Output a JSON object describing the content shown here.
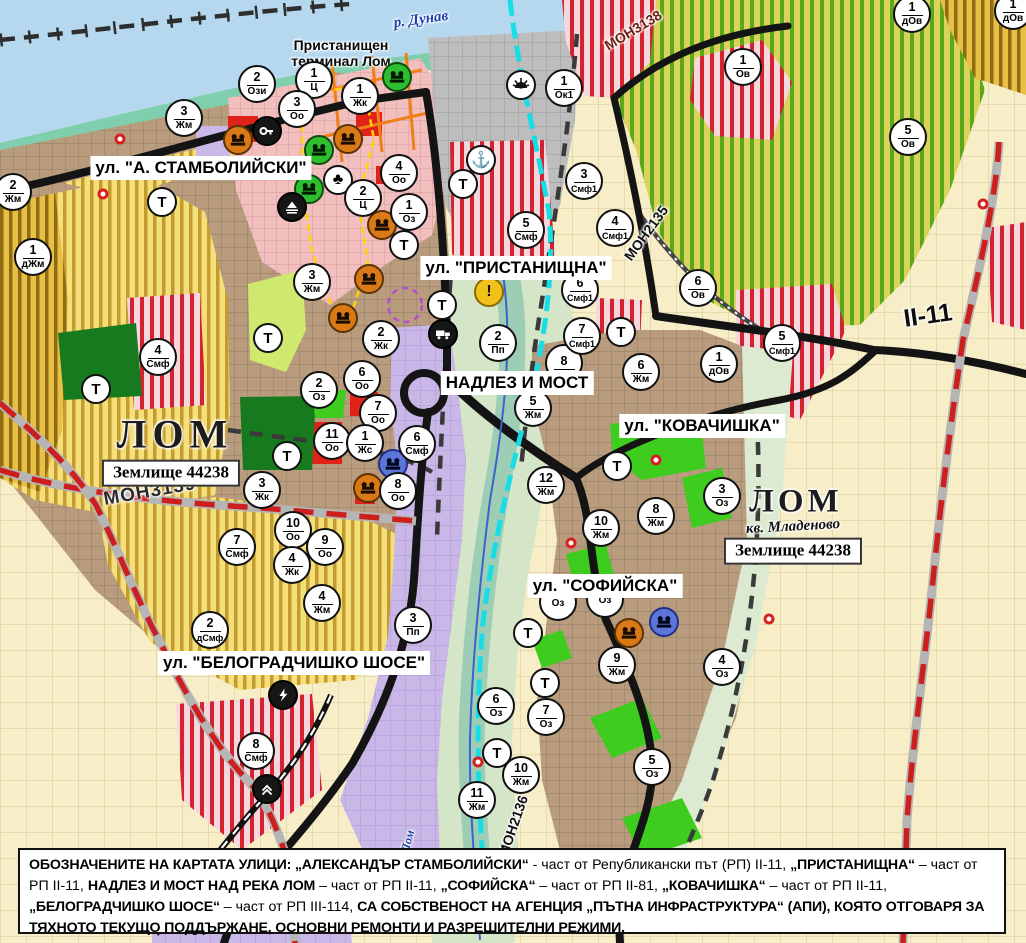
{
  "map_title": "Устройствен план на гр. Лом - обозначени улици на АПИ",
  "colors": {
    "water": "#b5d8ef",
    "shore": "#7fcfae",
    "urban_brown": "#b99c7e",
    "pink_center": "#f3bebe",
    "yellow_zone": "#f5df7a",
    "yellow_stripe": "#c49b2e",
    "mustard_zone": "#e9bf45",
    "vineyard_base": "#d8d35b",
    "vineyard_stripe": "#5ca81c",
    "smf_base": "#f6d7de",
    "smf_stripe": "#d4232e",
    "red_zone": "#e02218",
    "green_zone": "#3ecc1e",
    "dark_green": "#177a1e",
    "violet_zone": "#c9b7e8",
    "gray_port": "#bdbdbd",
    "cream": "#f7eec8",
    "road_black": "#141414",
    "road_red_dash": "#ce1f1f",
    "cyan_channel": "#17dde7",
    "river_blue": "#3b63c8"
  },
  "street_labels": [
    {
      "text": "ул. \"А. СТАМБОЛИЙСКИ\"",
      "x": 201,
      "y": 168
    },
    {
      "text": "ул. \"ПРИСТАНИЩНА\"",
      "x": 516,
      "y": 268
    },
    {
      "text": "НАДЛЕЗ И МОСТ",
      "x": 517,
      "y": 383
    },
    {
      "text": "ул. \"КОВАЧИШКА\"",
      "x": 702,
      "y": 426
    },
    {
      "text": "ул. \"СОФИЙСКА\"",
      "x": 605,
      "y": 586
    },
    {
      "text": "ул. \"БЕЛОГРАДЧИШКО ШОСЕ\"",
      "x": 294,
      "y": 663
    }
  ],
  "place_labels": [
    {
      "cls": "danube",
      "text": "р. Дунав",
      "x": 421,
      "y": 20,
      "rot": -8
    },
    {
      "cls": "terminal",
      "text": "Пристанищен\nтерминал Лом",
      "x": 341,
      "y": 53,
      "rot": 0
    },
    {
      "cls": "lomcity",
      "text": "ЛОМ",
      "x": 175,
      "y": 434,
      "rot": 0
    },
    {
      "cls": "zembox",
      "text": "Землище\n44238",
      "x": 171,
      "y": 473,
      "rot": 0
    },
    {
      "cls": "lomcity2",
      "text": "ЛОМ",
      "x": 796,
      "y": 502,
      "rot": 0
    },
    {
      "cls": "kvartal",
      "text": "кв. Младеново",
      "x": 793,
      "y": 527,
      "rot": -3
    },
    {
      "cls": "zembox",
      "text": "Землище\n44238",
      "x": 793,
      "y": 551,
      "rot": 0
    },
    {
      "cls": "riverlom",
      "text": "Лом",
      "x": 408,
      "y": 841,
      "rot": -75
    }
  ],
  "road_codes": [
    {
      "cls": "code-lg",
      "text": "МОН3139",
      "x": 150,
      "y": 492,
      "rot": -10
    },
    {
      "cls": "code-red",
      "text": "МОН3138",
      "x": 633,
      "y": 30,
      "rot": -31
    },
    {
      "cls": "code-sm",
      "text": "МОН2135",
      "x": 646,
      "y": 233,
      "rot": -54
    },
    {
      "cls": "code-sm",
      "text": "МОН2136",
      "x": 513,
      "y": 826,
      "rot": -71
    },
    {
      "cls": "code-xl",
      "text": "II-11",
      "x": 928,
      "y": 316,
      "rot": -8
    }
  ],
  "zone_markers": [
    {
      "num": "2",
      "code": "Ози",
      "x": 257,
      "y": 84
    },
    {
      "num": "1",
      "code": "Ц",
      "x": 314,
      "y": 80
    },
    {
      "num": "3",
      "code": "Оо",
      "x": 297,
      "y": 109
    },
    {
      "num": "1",
      "code": "Жк",
      "x": 360,
      "y": 96
    },
    {
      "num": "1",
      "code": "Ок1",
      "x": 564,
      "y": 88
    },
    {
      "num": "3",
      "code": "Жм",
      "x": 184,
      "y": 118
    },
    {
      "num": "2",
      "code": "Жм",
      "x": 13,
      "y": 192
    },
    {
      "num": "1",
      "code": "дЖм",
      "x": 33,
      "y": 257
    },
    {
      "num": "4",
      "code": "Оо",
      "x": 399,
      "y": 173
    },
    {
      "num": "2",
      "code": "Ц",
      "x": 363,
      "y": 198
    },
    {
      "num": "1",
      "code": "Оз",
      "x": 409,
      "y": 212
    },
    {
      "num": "3",
      "code": "Смф1",
      "x": 584,
      "y": 181
    },
    {
      "num": "5",
      "code": "Смф",
      "x": 526,
      "y": 230
    },
    {
      "num": "4",
      "code": "Смф1",
      "x": 615,
      "y": 228
    },
    {
      "num": "6",
      "code": "Смф1",
      "x": 580,
      "y": 290
    },
    {
      "num": "1",
      "code": "Ов",
      "x": 743,
      "y": 67
    },
    {
      "num": "5",
      "code": "Ов",
      "x": 908,
      "y": 137
    },
    {
      "num": "1",
      "code": "дОв",
      "x": 912,
      "y": 14
    },
    {
      "num": "1",
      "code": "дОв",
      "x": 1013,
      "y": 11
    },
    {
      "num": "6",
      "code": "Ов",
      "x": 698,
      "y": 288
    },
    {
      "num": "5",
      "code": "Смф1",
      "x": 782,
      "y": 343
    },
    {
      "num": "1",
      "code": "дОв",
      "x": 719,
      "y": 364
    },
    {
      "num": "3",
      "code": "Жм",
      "x": 312,
      "y": 282
    },
    {
      "num": "4",
      "code": "Смф",
      "x": 158,
      "y": 357
    },
    {
      "num": "2",
      "code": "Жк",
      "x": 381,
      "y": 339
    },
    {
      "num": "6",
      "code": "Оо",
      "x": 362,
      "y": 379
    },
    {
      "num": "2",
      "code": "Оз",
      "x": 319,
      "y": 390
    },
    {
      "num": "7",
      "code": "Оо",
      "x": 378,
      "y": 413
    },
    {
      "num": "11",
      "code": "Оо",
      "x": 332,
      "y": 441
    },
    {
      "num": "1",
      "code": "Жс",
      "x": 365,
      "y": 443
    },
    {
      "num": "6",
      "code": "Смф",
      "x": 417,
      "y": 444
    },
    {
      "num": "8",
      "code": "Оо",
      "x": 398,
      "y": 491
    },
    {
      "num": "3",
      "code": "Жк",
      "x": 262,
      "y": 490
    },
    {
      "num": "10",
      "code": "Оо",
      "x": 293,
      "y": 530
    },
    {
      "num": "9",
      "code": "Оо",
      "x": 325,
      "y": 547
    },
    {
      "num": "4",
      "code": "Жк",
      "x": 292,
      "y": 565
    },
    {
      "num": "7",
      "code": "Смф",
      "x": 237,
      "y": 547
    },
    {
      "num": "2",
      "code": "Пп",
      "x": 498,
      "y": 343
    },
    {
      "num": "8",
      "code": "",
      "x": 564,
      "y": 363
    },
    {
      "num": "5",
      "code": "Жм",
      "x": 533,
      "y": 408
    },
    {
      "num": "12",
      "code": "Жм",
      "x": 546,
      "y": 485
    },
    {
      "num": "7",
      "code": "Смф1",
      "x": 582,
      "y": 336
    },
    {
      "num": "6",
      "code": "Жм",
      "x": 641,
      "y": 372
    },
    {
      "num": "8",
      "code": "Жм",
      "x": 656,
      "y": 516
    },
    {
      "num": "3",
      "code": "Оз",
      "x": 722,
      "y": 496
    },
    {
      "num": "10",
      "code": "Жм",
      "x": 601,
      "y": 528
    },
    {
      "num": "9",
      "code": "Жм",
      "x": 617,
      "y": 665
    },
    {
      "num": "4",
      "code": "Оз",
      "x": 722,
      "y": 667
    },
    {
      "num": "6",
      "code": "Оз",
      "x": 496,
      "y": 706
    },
    {
      "num": "7",
      "code": "Оз",
      "x": 546,
      "y": 717
    },
    {
      "num": "10",
      "code": "Жм",
      "x": 521,
      "y": 775
    },
    {
      "num": "11",
      "code": "Жм",
      "x": 477,
      "y": 800
    },
    {
      "num": "5",
      "code": "Оз",
      "x": 652,
      "y": 767
    },
    {
      "num": "4",
      "code": "Жм",
      "x": 322,
      "y": 603
    },
    {
      "num": "2",
      "code": "дСмф",
      "x": 210,
      "y": 630
    },
    {
      "num": "3",
      "code": "Пп",
      "x": 413,
      "y": 625
    },
    {
      "num": "8",
      "code": "Смф",
      "x": 256,
      "y": 751
    },
    {
      "num": "",
      "code": "Оз",
      "x": 558,
      "y": 602
    },
    {
      "num": "",
      "code": "Оз",
      "x": 605,
      "y": 599
    }
  ],
  "t_markers": [
    {
      "x": 162,
      "y": 202
    },
    {
      "x": 404,
      "y": 245
    },
    {
      "x": 463,
      "y": 184
    },
    {
      "x": 442,
      "y": 305
    },
    {
      "x": 268,
      "y": 338
    },
    {
      "x": 96,
      "y": 389
    },
    {
      "x": 287,
      "y": 456
    },
    {
      "x": 621,
      "y": 332
    },
    {
      "x": 617,
      "y": 466
    },
    {
      "x": 528,
      "y": 633
    },
    {
      "x": 545,
      "y": 683
    },
    {
      "x": 497,
      "y": 753
    }
  ],
  "icon_markers": [
    {
      "type": "monument-orange",
      "x": 238,
      "y": 140
    },
    {
      "type": "monument-orange",
      "x": 348,
      "y": 139
    },
    {
      "type": "monument-orange",
      "x": 382,
      "y": 225
    },
    {
      "type": "monument-orange",
      "x": 369,
      "y": 279
    },
    {
      "type": "monument-orange",
      "x": 343,
      "y": 318
    },
    {
      "type": "monument-orange",
      "x": 368,
      "y": 488
    },
    {
      "type": "monument-orange",
      "x": 629,
      "y": 633
    },
    {
      "type": "monument-green",
      "x": 397,
      "y": 77
    },
    {
      "type": "monument-green",
      "x": 319,
      "y": 150
    },
    {
      "type": "monument-green",
      "x": 309,
      "y": 189
    },
    {
      "type": "monument-blue",
      "x": 393,
      "y": 464
    },
    {
      "type": "monument-blue",
      "x": 664,
      "y": 622
    },
    {
      "type": "key-black",
      "x": 267,
      "y": 131
    },
    {
      "type": "dune-black",
      "x": 292,
      "y": 207
    },
    {
      "type": "trefoil-white",
      "x": 338,
      "y": 180
    },
    {
      "type": "anchor-white",
      "x": 481,
      "y": 160
    },
    {
      "type": "sun-white",
      "x": 521,
      "y": 85
    },
    {
      "type": "truck-black",
      "x": 443,
      "y": 334
    },
    {
      "type": "lightning-black",
      "x": 283,
      "y": 695
    },
    {
      "type": "crossing-black",
      "x": 267,
      "y": 789
    },
    {
      "type": "warning-yellow",
      "x": 489,
      "y": 292
    }
  ],
  "red_dots": [
    {
      "x": 120,
      "y": 139
    },
    {
      "x": 103,
      "y": 194
    },
    {
      "x": 571,
      "y": 543
    },
    {
      "x": 656,
      "y": 460
    },
    {
      "x": 478,
      "y": 762
    },
    {
      "x": 769,
      "y": 619
    },
    {
      "x": 983,
      "y": 204
    }
  ],
  "footer": {
    "segments": [
      {
        "b": true,
        "t": "ОБОЗНАЧЕНИТЕ НА КАРТАТА УЛИЦИ: „АЛЕКСАНДЪР СТАМБОЛИЙСКИ“"
      },
      {
        "b": false,
        "t": " - част от Републикански път (РП) II-11, "
      },
      {
        "b": true,
        "t": "„ПРИСТАНИЩНА“"
      },
      {
        "b": false,
        "t": " – част от РП II-11, "
      },
      {
        "b": true,
        "t": "НАДЛЕЗ И МОСТ НАД РЕКА ЛОМ"
      },
      {
        "b": false,
        "t": " – част от РП II-11, "
      },
      {
        "b": true,
        "t": "„СОФИЙСКА“"
      },
      {
        "b": false,
        "t": " – част от РП II-81, "
      },
      {
        "b": true,
        "t": "„КОВАЧИШКА“"
      },
      {
        "b": false,
        "t": " – част от РП II-11, "
      },
      {
        "b": true,
        "t": "„БЕЛОГРАДЧИШКО ШОСЕ“"
      },
      {
        "b": false,
        "t": " – част от РП III-114, "
      },
      {
        "b": true,
        "t": "СА СОБСТВЕНОСТ НА АГЕНЦИЯ „ПЪТНА ИНФРАСТРУКТУРА“ (АПИ), КОЯТО ОТГОВАРЯ ЗА ТЯХНОТО ТЕКУЩО ПОДДЪРЖАНЕ, ОСНОВНИ РЕМОНТИ И РАЗРЕШИТЕЛНИ РЕЖИМИ."
      }
    ]
  }
}
